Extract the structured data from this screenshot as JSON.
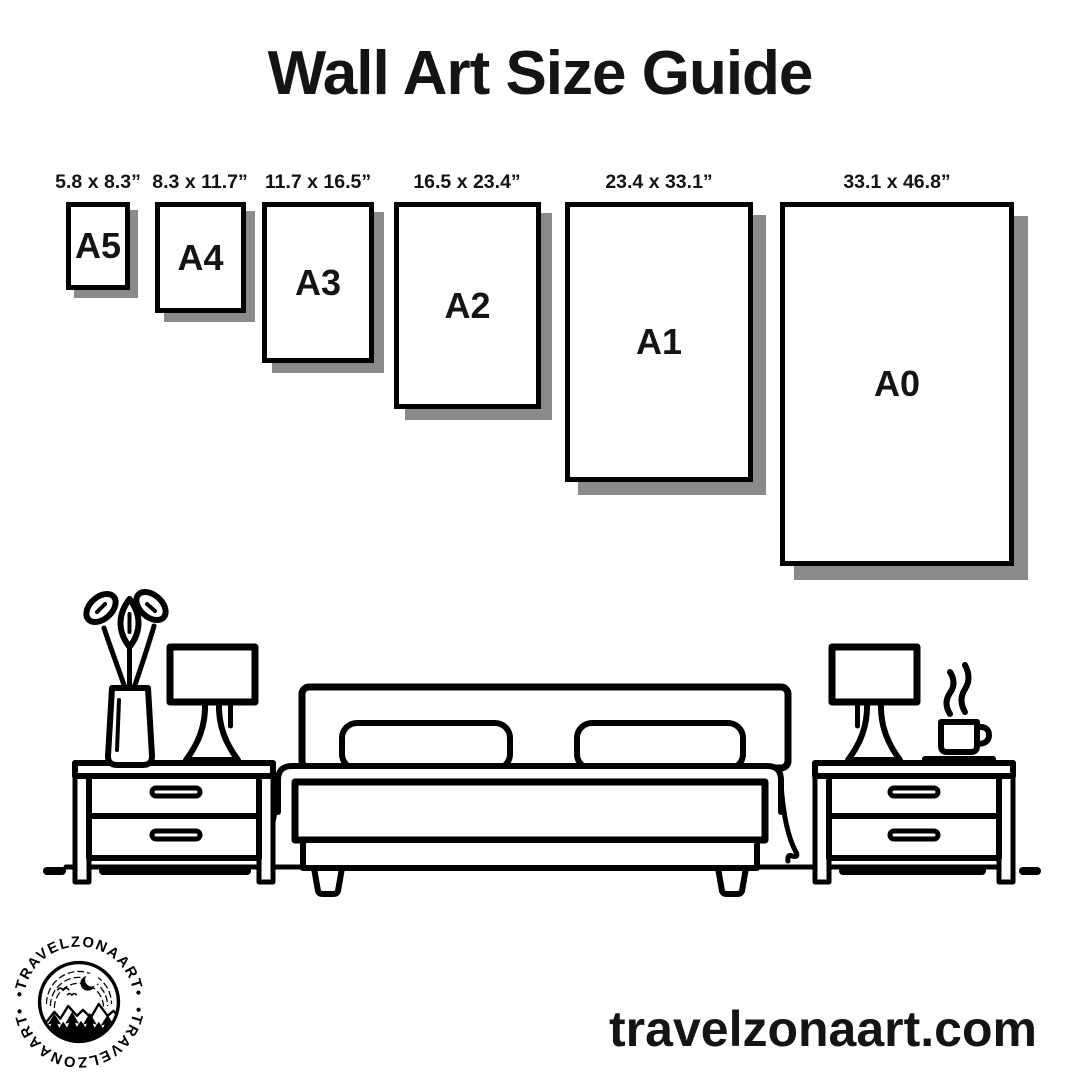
{
  "title": "Wall Art Size Guide",
  "sizes": [
    {
      "name": "A5",
      "dimensions": "5.8 x 8.3”"
    },
    {
      "name": "A4",
      "dimensions": "8.3 x 11.7”"
    },
    {
      "name": "A3",
      "dimensions": "11.7 x 16.5”"
    },
    {
      "name": "A2",
      "dimensions": "16.5 x 23.4”"
    },
    {
      "name": "A1",
      "dimensions": "23.4 x 33.1”"
    },
    {
      "name": "A0",
      "dimensions": "33.1 x 46.8”"
    }
  ],
  "logo": {
    "brand": "TRAVELZONAART",
    "ring_text_top": "•TRAVELZONAART•",
    "ring_text_bottom": "•TRAVELZONAART•"
  },
  "website": "travelzonaart.com",
  "colors": {
    "ink": "#000000",
    "paper": "#ffffff",
    "shadow": "#8a8a8a"
  },
  "illustration": {
    "name": "bedroom-line-art",
    "elements": [
      "vase-with-flowers",
      "table-lamp-left",
      "nightstand-left",
      "double-bed",
      "nightstand-right",
      "table-lamp-right",
      "coffee-cup-with-steam",
      "floor-line"
    ]
  }
}
